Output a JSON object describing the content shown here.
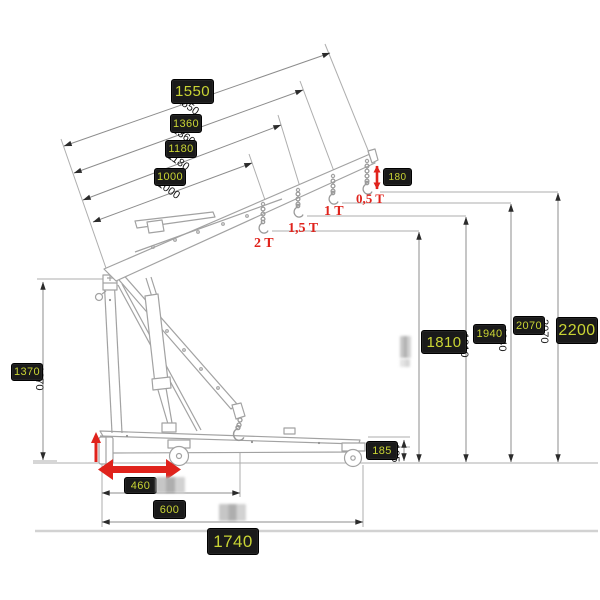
{
  "colors": {
    "badge_bg": "#1a1a1a",
    "badge_text": "#c9d434",
    "capacity_red": "#e0231c",
    "drawing_grey": "#a2a2a2",
    "dimension_grey": "#8c8c8c"
  },
  "labels": {
    "l1550": "1550",
    "l1360": "1360",
    "l1180": "1180",
    "l1000": "1000",
    "l180": "180",
    "l1810": "1810",
    "l1940": "1940",
    "l2070": "2070",
    "l2200": "2200",
    "l1370": "1370",
    "l185": "185",
    "l460": "460",
    "l600": "600",
    "l1740": "1740"
  },
  "capacities": {
    "t2": "2 T",
    "t15": "1,5 T",
    "t1": "1 T",
    "t05": "0,5 T"
  },
  "ghosts": {
    "g1550": "1550",
    "g1360": "1360",
    "g1180": "1180",
    "g1000": "1000",
    "g1810": "1810",
    "g1940": "1940",
    "g2070": "2070",
    "g185": "185",
    "g1370": "1370"
  },
  "diagram": {
    "type": "technical-dimension-drawing",
    "subject": "folding engine crane, side view with boom shown raised and lowered",
    "boom_positions": [
      {
        "boom_length": 1000,
        "capacity": "2 T",
        "hook_height": 1810
      },
      {
        "boom_length": 1180,
        "capacity": "1,5 T",
        "hook_height": 1940
      },
      {
        "boom_length": 1360,
        "capacity": "1 T",
        "hook_height": 2070
      },
      {
        "boom_length": 1550,
        "capacity": "0,5 T",
        "hook_height": 2200
      }
    ],
    "other_dimensions": {
      "mast_pivot_height": 1370,
      "tip_hook_drop": 180,
      "rear_wheel_height": 185,
      "front_adjust": 460,
      "lowered_hook_reach": 600,
      "overall_length": 1740
    }
  }
}
